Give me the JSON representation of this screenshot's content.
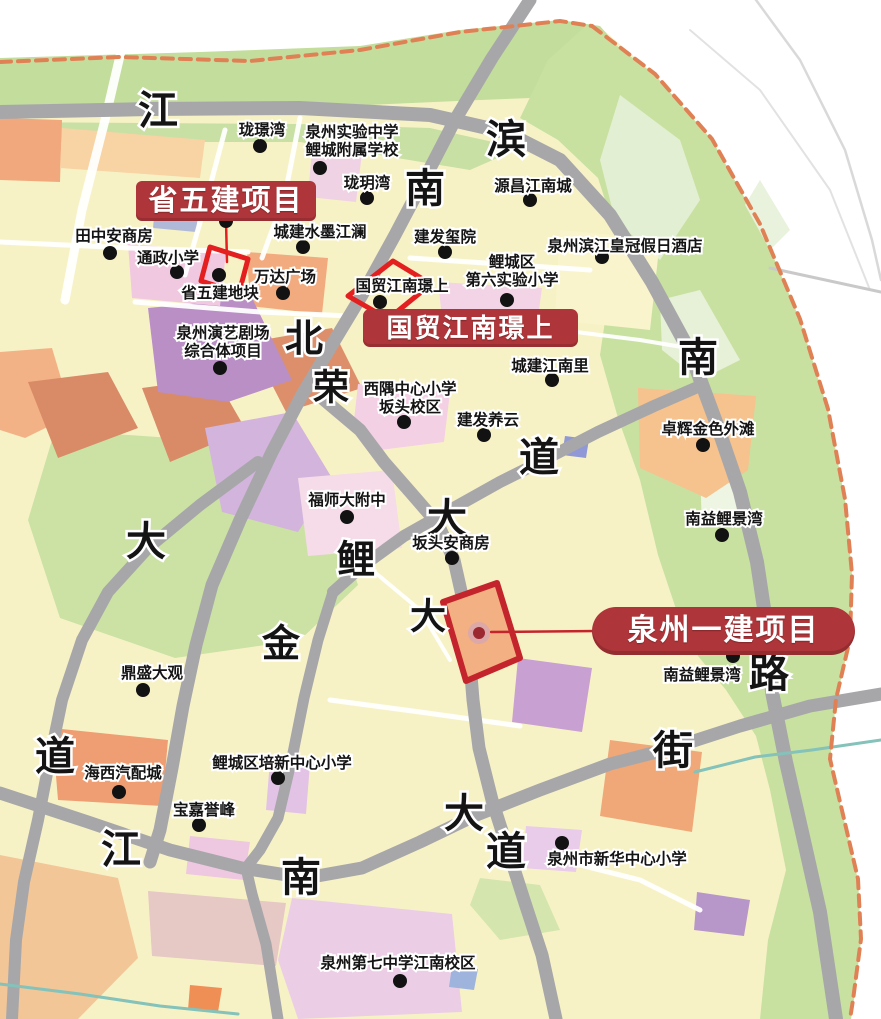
{
  "canvas": {
    "width": 881,
    "height": 1019,
    "background": "#ffffff"
  },
  "colors": {
    "land": "#f7f2c6",
    "green": "#c8e1a1",
    "green_light": "#e7f1d8",
    "road_gray": "#a7a7aa",
    "river_dash": "#e08055",
    "stream": "#84c2ba",
    "poi_text": "#141414",
    "dot": "#121212",
    "banner_red": "#ae3539",
    "outline_red": "#e41f1f",
    "outline_dark_red": "#c4242c",
    "marker_ring": "#dca8a8",
    "marker_core": "#9c2830"
  },
  "banners": {
    "shengwujian": "省五建项目",
    "guomao": "国贸江南璟上",
    "yijian": "泉州一建项目"
  },
  "map": {
    "zones": [
      {
        "name": "land-base",
        "fill": "#f7f2c6",
        "points": "0,63 120,57 250,60 360,50 460,33 560,21 600,27 655,75 712,140 760,225 800,320 828,410 845,500 852,575 850,640 836,700 830,760 844,820 858,880 861,940 854,1000 851,1019 0,1019"
      },
      {
        "name": "green-top-band",
        "fill": "#c3dd9c",
        "points": "0,58 200,52 360,46 460,30 560,20 600,26 640,72 610,95 480,100 300,108 120,110 0,108"
      },
      {
        "name": "green-top-strip",
        "fill": "#c9e0a4",
        "points": "0,122 300,124 430,128 520,148 470,170 300,142 0,142"
      },
      {
        "name": "green-riverbank",
        "fill": "#c8e1a1",
        "points": "588,24 655,75 712,140 760,225 800,320 828,410 845,500 852,575 850,640 836,700 830,760 844,820 858,880 861,940 854,1000 851,1019 760,1019 768,940 786,870 770,790 756,736 726,690 698,656 678,615 658,555 640,480 618,418 600,355 608,300 618,240 598,178 558,140 520,118 548,60"
      },
      {
        "name": "green-light-patch",
        "fill": "#e7f1d8",
        "points": "660,300 700,290 740,360 700,380 662,350"
      },
      {
        "name": "green-light-patch",
        "fill": "#eef5e2",
        "points": "700,470 735,465 740,520 702,528"
      },
      {
        "name": "green-light-patch",
        "fill": "#e9f2dc",
        "points": "745,205 760,180 790,230 770,250"
      },
      {
        "name": "green-light-patch",
        "fill": "#e3efd2",
        "points": "620,95 680,140 700,200 660,260 615,220 600,160"
      },
      {
        "name": "green-central",
        "fill": "#cbe2a4",
        "points": "55,430 230,442 335,515 358,585 300,640 175,658 60,618 28,520"
      },
      {
        "name": "green-small",
        "fill": "#d4e6ae",
        "points": "480,878 540,885 560,930 500,940 470,905"
      },
      {
        "name": "yellow-block",
        "fill": "#faf4cc",
        "points": "560,230 660,240 650,330 555,320"
      },
      {
        "name": "orange-left-top",
        "fill": "#f0a87c",
        "points": "0,118 62,120 60,182 0,180"
      },
      {
        "name": "peach-top",
        "fill": "#f8d3a4",
        "points": "62,128 205,140 200,178 60,168"
      },
      {
        "name": "orange-left",
        "fill": "#f3b285",
        "points": "0,352 52,348 72,415 25,438 0,430"
      },
      {
        "name": "orange-wanda",
        "fill": "#f2ab7e",
        "points": "247,252 328,258 322,314 250,306"
      },
      {
        "name": "orange-zhuohui",
        "fill": "#f6c28d",
        "points": "638,388 756,396 748,470 706,498 640,468"
      },
      {
        "name": "orange-bottom-center",
        "fill": "#f0a878",
        "points": "610,740 702,752 692,832 600,816"
      },
      {
        "name": "orange-haixi",
        "fill": "#ee9e72",
        "points": "52,728 168,740 162,806 58,800"
      },
      {
        "name": "orange-bottom-left",
        "fill": "#f3c697",
        "points": "0,855 118,878 138,958 78,1019 0,1019"
      },
      {
        "name": "orange-red-small",
        "fill": "#ef8f55",
        "points": "190,985 222,988 218,1012 188,1010"
      },
      {
        "name": "brick-block",
        "fill": "#d98b67",
        "points": "28,382 108,372 138,428 58,458"
      },
      {
        "name": "brick-block",
        "fill": "#d98b67",
        "points": "142,388 216,378 246,430 170,462"
      },
      {
        "name": "brick-block",
        "fill": "#dd8f6c",
        "points": "250,342 332,328 362,388 286,412"
      },
      {
        "name": "purple-theater",
        "fill": "#b98fc6",
        "points": "148,308 252,298 292,380 228,402 158,392"
      },
      {
        "name": "purple-lavender",
        "fill": "#d3b4dc",
        "points": "205,428 292,412 332,478 298,532 222,512"
      },
      {
        "name": "purple-bottom",
        "fill": "#c8a0d1",
        "points": "518,658 592,668 582,732 512,722"
      },
      {
        "name": "purple-small-bottom",
        "fill": "#b797c9",
        "points": "697,892 750,900 744,936 694,930"
      },
      {
        "name": "pink-tongzheng",
        "fill": "#f0c9e0",
        "points": "128,244 226,252 220,306 132,298"
      },
      {
        "name": "pink-xiyu",
        "fill": "#f4d0e5",
        "points": "358,384 450,392 444,442 380,450 354,420"
      },
      {
        "name": "pink-fushida",
        "fill": "#f6dbe9",
        "points": "298,478 392,470 402,548 308,556"
      },
      {
        "name": "pink-diliu",
        "fill": "#f3d4e6",
        "points": "438,282 542,288 536,332 443,326"
      },
      {
        "name": "pink-bottom-big",
        "fill": "#ebcee6",
        "points": "292,898 452,914 462,1012 298,1019 278,960"
      },
      {
        "name": "pink-peixin",
        "fill": "#e2c3e5",
        "points": "270,760 310,764 306,814 266,810"
      },
      {
        "name": "pink-xinhua",
        "fill": "#e8cce9",
        "points": "526,826 582,830 576,872 522,868"
      },
      {
        "name": "rose-bottom",
        "fill": "#e6c8c4",
        "points": "148,891 286,903 276,966 152,956"
      },
      {
        "name": "pink-small",
        "fill": "#eec7e0",
        "points": "190,836 250,842 244,880 186,874"
      },
      {
        "name": "pink-top-school",
        "fill": "#f0d2e5",
        "points": "312,148 362,153 356,202 308,197"
      },
      {
        "name": "bluegray-block",
        "fill": "#b0bad8",
        "points": "156,193 200,197 196,232 153,228"
      },
      {
        "name": "bluegray-block",
        "fill": "#9198d6",
        "points": "565,436 589,439 586,458 562,455"
      },
      {
        "name": "bluegray-block",
        "fill": "#9fb4dc",
        "points": "452,966 478,969 474,990 449,987"
      },
      {
        "name": "orange-yijian-parcel",
        "fill": "#f3b082",
        "points": "443,602 497,583 520,658 466,681"
      }
    ],
    "white_streets": [
      {
        "points": "133,0 105,120 82,210 65,300",
        "width": 9
      },
      {
        "points": "225,130 205,205 185,275",
        "width": 5
      },
      {
        "points": "300,118 285,195 262,258",
        "width": 5
      },
      {
        "points": "0,242 130,248 248,252",
        "width": 5
      },
      {
        "points": "135,302 260,312 350,316",
        "width": 5
      },
      {
        "points": "410,258 500,264 590,270",
        "width": 5
      },
      {
        "points": "330,700 420,712 520,726",
        "width": 5
      },
      {
        "points": "560,330 640,340 700,350",
        "width": 4
      },
      {
        "points": "360,560 420,610 450,660",
        "width": 4
      },
      {
        "points": "560,860 640,880 700,910",
        "width": 5
      }
    ],
    "roads": [
      {
        "name": "riverside-road",
        "points": "0,112 150,109 300,108 430,115 505,132 560,160 610,215 652,282 690,352 716,422 740,492 757,562 768,635 772,692 786,762 802,832 820,912 836,1019",
        "width": 14
      },
      {
        "name": "diagonal-road-ne-sw",
        "points": "530,0 492,58 455,120 425,178 395,235 362,295 330,348 302,395 272,452 240,520 212,585 196,645 183,706 172,768 160,830 150,862",
        "width": 13
      },
      {
        "name": "left-road",
        "points": "258,462 200,505 148,548 108,592 82,640 62,700 50,758 38,820 24,882 16,940 12,1019",
        "width": 12
      },
      {
        "name": "avenue-ne",
        "points": "333,592 360,568 404,536 450,510 500,482 540,462 598,432 654,406 700,386",
        "width": 12
      },
      {
        "name": "central-left-road",
        "points": "333,592 318,640 304,698 292,758 278,818 260,850 246,868 252,894 266,944 278,1019",
        "width": 11
      },
      {
        "name": "central-avenue",
        "points": "322,398 360,430 384,462 412,494 438,524 454,560 463,600 469,650 473,700 479,748 492,800 508,850 524,900 542,955 556,1019",
        "width": 13
      },
      {
        "name": "bottom-street",
        "points": "0,793 88,822 170,850 242,868 306,878 362,868 420,842 474,816 540,790 610,764 672,748 740,726 810,706 881,694",
        "width": 13
      }
    ],
    "faint_lines": [
      {
        "points": "756,0 800,60 845,150 872,240 881,280",
        "width": 2.5,
        "color": "#d9d9d9"
      },
      {
        "points": "690,30 760,90 830,190 870,290",
        "width": 2,
        "color": "#e2e2e2"
      },
      {
        "points": "770,268 881,292",
        "width": 3,
        "color": "#c9c9c9"
      }
    ],
    "streams": [
      {
        "points": "695,772 755,757 812,750 881,740"
      },
      {
        "points": "0,984 80,994 160,1006 238,1014"
      }
    ],
    "river_dashes": [
      {
        "points": "0,62 120,57 250,61 360,50 460,32 560,21 592,26"
      },
      {
        "points": "592,26 655,74 712,139 760,224 800,319 828,409 845,499 852,574 850,639 836,699 830,759 844,819 858,879 861,939 853,1000 850,1019"
      }
    ],
    "road_labels": [
      {
        "text": "江",
        "x": 158,
        "y": 110,
        "size": 40
      },
      {
        "text": "滨",
        "x": 506,
        "y": 139,
        "size": 40
      },
      {
        "text": "南",
        "x": 425,
        "y": 188,
        "size": 40
      },
      {
        "text": "北",
        "x": 304,
        "y": 338,
        "size": 38
      },
      {
        "text": "荣",
        "x": 331,
        "y": 387,
        "size": 36
      },
      {
        "text": "南",
        "x": 698,
        "y": 357,
        "size": 40
      },
      {
        "text": "道",
        "x": 539,
        "y": 457,
        "size": 40
      },
      {
        "text": "大",
        "x": 447,
        "y": 518,
        "size": 40
      },
      {
        "text": "鲤",
        "x": 356,
        "y": 559,
        "size": 38
      },
      {
        "text": "大",
        "x": 146,
        "y": 541,
        "size": 40
      },
      {
        "text": "金",
        "x": 281,
        "y": 643,
        "size": 38
      },
      {
        "text": "大",
        "x": 428,
        "y": 616,
        "size": 36
      },
      {
        "text": "路",
        "x": 769,
        "y": 673,
        "size": 40
      },
      {
        "text": "道",
        "x": 55,
        "y": 756,
        "size": 40
      },
      {
        "text": "江",
        "x": 121,
        "y": 849,
        "size": 40
      },
      {
        "text": "南",
        "x": 301,
        "y": 877,
        "size": 40
      },
      {
        "text": "大",
        "x": 464,
        "y": 813,
        "size": 40
      },
      {
        "text": "道",
        "x": 506,
        "y": 851,
        "size": 40
      },
      {
        "text": "街",
        "x": 673,
        "y": 750,
        "size": 40
      }
    ],
    "pois": [
      {
        "name": "longjingwan",
        "dot": [
          260,
          146
        ],
        "label": {
          "lines": [
            "珑璟湾"
          ],
          "x": 262,
          "y": 129
        }
      },
      {
        "name": "quanzhou-shiyan-zhongxue",
        "dot": [
          320,
          168
        ],
        "label": {
          "lines": [
            "泉州实验中学",
            "鲤城附属学校"
          ],
          "x": 352,
          "y": 131
        }
      },
      {
        "name": "longyuewan",
        "dot": [
          367,
          198
        ],
        "label": {
          "lines": [
            "珑玥湾"
          ],
          "x": 367,
          "y": 182
        }
      },
      {
        "name": "yuanchang-jiangnancheng",
        "dot": [
          530,
          200
        ],
        "label": {
          "lines": [
            "源昌江南城"
          ],
          "x": 533,
          "y": 185
        }
      },
      {
        "name": "tianzhongan-shangfang",
        "dot": [
          110,
          253
        ],
        "label": {
          "lines": [
            "田中安商房"
          ],
          "x": 114,
          "y": 235
        }
      },
      {
        "name": "tongzheng-xiaoxue",
        "dot": [
          177,
          272
        ],
        "label": {
          "lines": [
            "通政小学"
          ],
          "x": 168,
          "y": 257
        }
      },
      {
        "name": "chengjian-shuimo-jianglan",
        "dot": [
          303,
          247
        ],
        "label": {
          "lines": [
            "城建水墨江澜"
          ],
          "x": 320,
          "y": 231
        }
      },
      {
        "name": "jianfa-xiyuan",
        "dot": [
          445,
          252
        ],
        "label": {
          "lines": [
            "建发玺院"
          ],
          "x": 445,
          "y": 236
        }
      },
      {
        "name": "binjiang-huangguan-jiudian",
        "dot": [
          602,
          257
        ],
        "label": {
          "lines": [
            "泉州滨江皇冠假日酒店"
          ],
          "x": 625,
          "y": 245
        }
      },
      {
        "name": "diliu-shiyan-xiaoxue",
        "dot": [
          507,
          300
        ],
        "label": {
          "lines": [
            "鲤城区",
            "第六实验小学"
          ],
          "x": 512,
          "y": 261
        }
      },
      {
        "name": "wanda-guangchang",
        "dot": [
          283,
          293
        ],
        "label": {
          "lines": [
            "万达广场"
          ],
          "x": 285,
          "y": 276
        }
      },
      {
        "name": "shengwujian-dikuai",
        "dot": [
          219,
          275
        ],
        "label": {
          "lines": [
            "省五建地块"
          ],
          "x": 220,
          "y": 292
        }
      },
      {
        "name": "guomao-jiangnan-jingshang-small",
        "dot": [
          380,
          302
        ],
        "label": {
          "lines": [
            "国贸江南璟上"
          ],
          "x": 402,
          "y": 285
        }
      },
      {
        "name": "yanyi-juchang",
        "dot": [
          220,
          368
        ],
        "label": {
          "lines": [
            "泉州演艺剧场",
            "综合体项目"
          ],
          "x": 223,
          "y": 332
        }
      },
      {
        "name": "chengjian-jiangnanli",
        "dot": [
          552,
          380
        ],
        "label": {
          "lines": [
            "城建江南里"
          ],
          "x": 550,
          "y": 365
        }
      },
      {
        "name": "xiyu-zhongxin-xiaoxue",
        "dot": [
          404,
          422
        ],
        "label": {
          "lines": [
            "西隅中心小学",
            "坂头校区"
          ],
          "x": 410,
          "y": 388
        }
      },
      {
        "name": "jianfa-yangyun",
        "dot": [
          484,
          435
        ],
        "label": {
          "lines": [
            "建发养云"
          ],
          "x": 488,
          "y": 419
        }
      },
      {
        "name": "zhuohui-jinse-waitan",
        "dot": [
          703,
          445
        ],
        "label": {
          "lines": [
            "卓辉金色外滩"
          ],
          "x": 708,
          "y": 428
        }
      },
      {
        "name": "fushida-fuzhong",
        "dot": [
          347,
          517
        ],
        "label": {
          "lines": [
            "福师大附中"
          ],
          "x": 347,
          "y": 499
        }
      },
      {
        "name": "nanyi-lijingwan-north",
        "dot": [
          722,
          535
        ],
        "label": {
          "lines": [
            "南益鲤景湾"
          ],
          "x": 724,
          "y": 518
        }
      },
      {
        "name": "bantou-anshangfang",
        "dot": [
          452,
          558
        ],
        "label": {
          "lines": [
            "坂头安商房"
          ],
          "x": 451,
          "y": 542
        }
      },
      {
        "name": "dingsheng-daguan",
        "dot": [
          143,
          690
        ],
        "label": {
          "lines": [
            "鼎盛大观"
          ],
          "x": 152,
          "y": 672
        }
      },
      {
        "name": "nanyi-lijingwan-south",
        "dot": [
          733,
          656
        ],
        "label": {
          "lines": [
            "南益鲤景湾"
          ],
          "x": 702,
          "y": 674
        }
      },
      {
        "name": "haixi-qipeicheng",
        "dot": [
          119,
          792
        ],
        "label": {
          "lines": [
            "海西汽配城"
          ],
          "x": 123,
          "y": 772
        }
      },
      {
        "name": "peixin-zhongxin-xiaoxue",
        "dot": [
          278,
          778
        ],
        "label": {
          "lines": [
            "鲤城区培新中心小学"
          ],
          "x": 282,
          "y": 762
        }
      },
      {
        "name": "baojia-yufeng",
        "dot": [
          199,
          825
        ],
        "label": {
          "lines": [
            "宝嘉誉峰"
          ],
          "x": 204,
          "y": 809
        }
      },
      {
        "name": "xinhua-zhongxin-xiaoxue",
        "dot": [
          562,
          843
        ],
        "label": {
          "lines": [
            "泉州市新华中心小学"
          ],
          "x": 617,
          "y": 858
        }
      },
      {
        "name": "diqizhongxue-jiangnan-xiaoqu",
        "dot": [
          400,
          981
        ],
        "label": {
          "lines": [
            "泉州第七中学江南校区"
          ],
          "x": 398,
          "y": 962
        }
      }
    ],
    "annotations": {
      "shengwujian": {
        "dot": [
          226,
          221
        ],
        "leader": [
          226,
          221,
          227,
          262
        ],
        "outline_points": "210,247 248,259 239,293 201,281",
        "outline_color": "#e41f1f",
        "outline_width": 5
      },
      "guomao": {
        "outline_points": "348,296 393,261 431,284 388,319",
        "outline_color": "#e41f1f",
        "outline_width": 5
      },
      "yijian": {
        "outline_points": "443,602 497,583 520,658 466,681",
        "outline_color": "#c4242c",
        "outline_width": 6,
        "outline_fill": "#f3b082",
        "marker": [
          479,
          633
        ],
        "marker_ring_r": 11,
        "marker_core_r": 6,
        "leader": [
          491,
          632,
          597,
          631
        ]
      }
    }
  }
}
